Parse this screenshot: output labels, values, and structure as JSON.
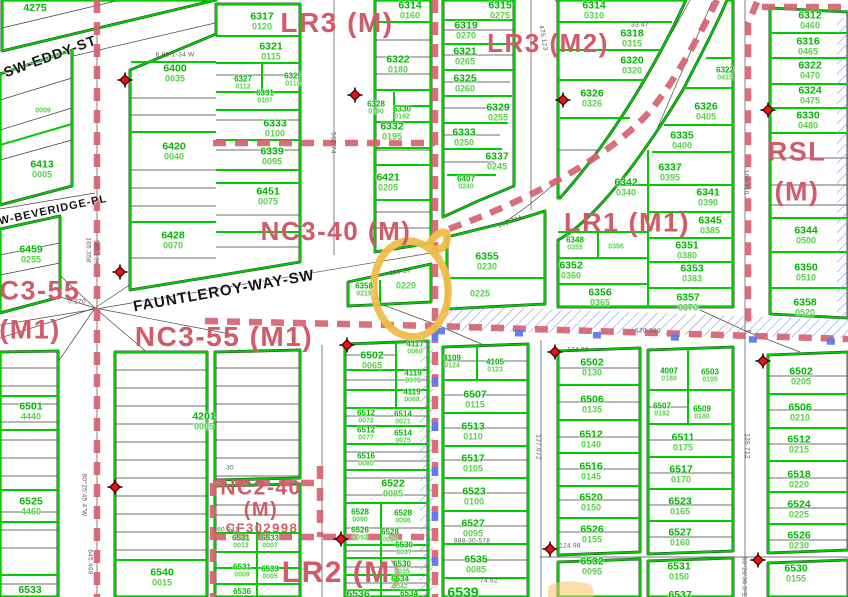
{
  "map": {
    "width": 848,
    "height": 597,
    "description": "zoning and parcel map with highlighted lot"
  },
  "colors": {
    "parcel_line": "#00cc00",
    "parcel_number_text": "#00b800",
    "lot_number_text": "#58d04a",
    "zoning_text": "#d15b68",
    "zoning_boundary": "#d5ününün"
  },
  "colors_fix": "see colors2",
  "colors2": {
    "parcel_line": "#00cc00",
    "parcel_number_text": "#00b800",
    "lot_number_text": "#58d04a",
    "zoning_text": "#d15b68",
    "zoning_boundary": "#d56370",
    "overlay_dash_blue": "#5b7bf0",
    "hatch_blue": "#7b8cf0",
    "marker_red": "#e81414",
    "highlight_orange": "#f0bd4a"
  },
  "highlight_circle": {
    "cx": 411,
    "cy": 289,
    "rx": 37,
    "ry": 48,
    "target_lot": "0220"
  },
  "zoning_labels": [
    {
      "text": "LR3 (M)",
      "x": 337,
      "y": 23,
      "size": 28
    },
    {
      "text": "LR3 (M2)",
      "x": 548,
      "y": 43,
      "size": 26
    },
    {
      "text": "LR1 (M1)",
      "x": 627,
      "y": 223,
      "size": 27
    },
    {
      "text": "RSL",
      "x": 797,
      "y": 152,
      "size": 27
    },
    {
      "text": "(M)",
      "x": 797,
      "y": 192,
      "size": 27
    },
    {
      "text": "NC3-40 (M)",
      "x": 336,
      "y": 231,
      "size": 26
    },
    {
      "text": "C3-55",
      "x": 40,
      "y": 291,
      "size": 27
    },
    {
      "text": "(M1)",
      "x": 30,
      "y": 330,
      "size": 27
    },
    {
      "text": "NC3-55 (M1)",
      "x": 224,
      "y": 337,
      "size": 28
    },
    {
      "text": "NC2-40",
      "x": 261,
      "y": 488,
      "size": 21
    },
    {
      "text": "(M)",
      "x": 261,
      "y": 510,
      "size": 20
    },
    {
      "text": "CF302998",
      "x": 262,
      "y": 528,
      "size": 13
    },
    {
      "text": "LR2 (M)",
      "x": 342,
      "y": 573,
      "size": 30
    }
  ],
  "street_labels": [
    {
      "text": "SW-EDDY-ST",
      "x": 50,
      "y": 56,
      "rot": -20,
      "size": 14
    },
    {
      "text": "SW-BEVERIDGE-PL",
      "x": 49,
      "y": 211,
      "rot": -12,
      "size": 11
    },
    {
      "text": "FAUNTLEROY-WAY-SW",
      "x": 224,
      "y": 291,
      "rot": -10,
      "size": 15
    }
  ],
  "parcel_labels": [
    {
      "n": "4275",
      "x": 35,
      "y": 8
    },
    {
      "l": "0009",
      "x": 43,
      "y": 111,
      "sz": "sm"
    },
    {
      "n": "6413",
      "l": "0005",
      "x": 42,
      "y": 169
    },
    {
      "n": "6459",
      "l": "0255",
      "x": 31,
      "y": 254
    },
    {
      "n": "6400",
      "l": "0035",
      "x": 175,
      "y": 73
    },
    {
      "n": "6420",
      "l": "0040",
      "x": 174,
      "y": 151
    },
    {
      "n": "6428",
      "l": "0070",
      "x": 173,
      "y": 240
    },
    {
      "n": "6317",
      "l": "0120",
      "x": 262,
      "y": 21
    },
    {
      "n": "6321",
      "l": "0115",
      "x": 271,
      "y": 51
    },
    {
      "n": "6325",
      "l": "0110",
      "x": 293,
      "y": 80,
      "sz": "sm"
    },
    {
      "n": "6327",
      "l": "0112",
      "x": 243,
      "y": 83,
      "sz": "sm"
    },
    {
      "n": "6331",
      "l": "0107",
      "x": 265,
      "y": 97,
      "sz": "sm"
    },
    {
      "n": "6333",
      "l": "0100",
      "x": 275,
      "y": 128
    },
    {
      "n": "6339",
      "l": "0095",
      "x": 272,
      "y": 156
    },
    {
      "n": "6451",
      "l": "0075",
      "x": 268,
      "y": 196
    },
    {
      "n": "6314",
      "l": "0160",
      "x": 410,
      "y": 10
    },
    {
      "n": "6322",
      "l": "0180",
      "x": 398,
      "y": 64
    },
    {
      "n": "6328",
      "l": "0190",
      "x": 376,
      "y": 108,
      "sz": "sm"
    },
    {
      "n": "6330",
      "l": "0192",
      "x": 402,
      "y": 113,
      "sz": "sm"
    },
    {
      "n": "6332",
      "l": "0195",
      "x": 392,
      "y": 131
    },
    {
      "n": "6421",
      "l": "0205",
      "x": 388,
      "y": 182
    },
    {
      "n": "6407",
      "l": "0240",
      "x": 466,
      "y": 183,
      "sz": "sm"
    },
    {
      "n": "6358",
      "l": "0219",
      "x": 364,
      "y": 290,
      "sz": "sm"
    },
    {
      "l": "0220",
      "x": 406,
      "y": 286
    },
    {
      "l": "0225",
      "x": 480,
      "y": 294
    },
    {
      "n": "6355",
      "l": "0230",
      "x": 487,
      "y": 261
    },
    {
      "n": "6315",
      "l": "0275",
      "x": 500,
      "y": 10
    },
    {
      "n": "6319",
      "l": "0270",
      "x": 466,
      "y": 30
    },
    {
      "n": "6321",
      "l": "0265",
      "x": 465,
      "y": 56
    },
    {
      "n": "6325",
      "l": "0260",
      "x": 465,
      "y": 83
    },
    {
      "n": "6329",
      "l": "0255",
      "x": 498,
      "y": 112
    },
    {
      "n": "6333",
      "l": "0250",
      "x": 464,
      "y": 137
    },
    {
      "n": "6337",
      "l": "0245",
      "x": 497,
      "y": 161
    },
    {
      "n": "6314",
      "l": "0310",
      "x": 594,
      "y": 10
    },
    {
      "n": "6318",
      "l": "0315",
      "x": 632,
      "y": 38
    },
    {
      "n": "6320",
      "l": "0320",
      "x": 632,
      "y": 65
    },
    {
      "n": "6326",
      "l": "0326",
      "x": 592,
      "y": 98
    },
    {
      "n": "6342",
      "l": "0340",
      "x": 626,
      "y": 187
    },
    {
      "n": "6337",
      "l": "0395",
      "x": 670,
      "y": 172
    },
    {
      "n": "6341",
      "l": "0390",
      "x": 708,
      "y": 197
    },
    {
      "n": "6345",
      "l": "0385",
      "x": 710,
      "y": 225
    },
    {
      "n": "6348",
      "l": "0355",
      "x": 575,
      "y": 244,
      "sz": "sm"
    },
    {
      "l": "0356",
      "x": 616,
      "y": 247,
      "sz": "sm"
    },
    {
      "n": "6352",
      "l": "0360",
      "x": 571,
      "y": 270
    },
    {
      "n": "6351",
      "l": "0380",
      "x": 687,
      "y": 250
    },
    {
      "n": "6353",
      "l": "0383",
      "x": 692,
      "y": 273
    },
    {
      "n": "6356",
      "l": "0365",
      "x": 600,
      "y": 297
    },
    {
      "n": "6357",
      "l": "0370",
      "x": 688,
      "y": 302
    },
    {
      "n": "6322",
      "l": "0415",
      "x": 725,
      "y": 74,
      "sz": "sm"
    },
    {
      "n": "6326",
      "l": "0405",
      "x": 706,
      "y": 111
    },
    {
      "n": "6335",
      "l": "0400",
      "x": 682,
      "y": 140
    },
    {
      "n": "6312",
      "l": "0460",
      "x": 810,
      "y": 20
    },
    {
      "n": "6316",
      "l": "0465",
      "x": 808,
      "y": 46
    },
    {
      "n": "6322",
      "l": "0470",
      "x": 810,
      "y": 70
    },
    {
      "n": "6324",
      "l": "0475",
      "x": 810,
      "y": 95
    },
    {
      "n": "6330",
      "l": "0480",
      "x": 808,
      "y": 120
    },
    {
      "n": "6344",
      "l": "0500",
      "x": 806,
      "y": 235
    },
    {
      "n": "6350",
      "l": "0510",
      "x": 806,
      "y": 272
    },
    {
      "n": "6358",
      "l": "0520",
      "x": 805,
      "y": 307
    },
    {
      "n": "6501",
      "l": "4440",
      "x": 31,
      "y": 411
    },
    {
      "n": "6525",
      "l": "4460",
      "x": 31,
      "y": 506
    },
    {
      "n": "6533",
      "x": 30,
      "y": 590
    },
    {
      "n": "4201",
      "l": "0005",
      "x": 204,
      "y": 421
    },
    {
      "n": "6540",
      "l": "0015",
      "x": 162,
      "y": 577
    },
    {
      "n": "6531",
      "l": "0013",
      "x": 241,
      "y": 542,
      "sz": "sm"
    },
    {
      "n": "6533",
      "l": "0007",
      "x": 270,
      "y": 542,
      "sz": "sm"
    },
    {
      "n": "6531",
      "l": "0009",
      "x": 242,
      "y": 571,
      "sz": "sm"
    },
    {
      "n": "6533",
      "l": "0005",
      "x": 270,
      "y": 573,
      "sz": "sm"
    },
    {
      "n": "6536",
      "x": 242,
      "y": 592,
      "sz": "sm"
    },
    {
      "n": "6502",
      "l": "0065",
      "x": 372,
      "y": 360
    },
    {
      "n": "4117",
      "l": "0060",
      "x": 415,
      "y": 348,
      "sz": "sm"
    },
    {
      "n": "4119",
      "l": "0070",
      "x": 413,
      "y": 377,
      "sz": "sm"
    },
    {
      "n": "4119",
      "l": "0068",
      "x": 412,
      "y": 396,
      "sz": "sm"
    },
    {
      "n": "6512",
      "l": "0072",
      "x": 366,
      "y": 417,
      "sz": "sm"
    },
    {
      "n": "6514",
      "l": "0071",
      "x": 403,
      "y": 418,
      "sz": "sm"
    },
    {
      "n": "6512",
      "l": "0077",
      "x": 366,
      "y": 434,
      "sz": "sm"
    },
    {
      "n": "6514",
      "l": "0075",
      "x": 403,
      "y": 437,
      "sz": "sm"
    },
    {
      "n": "6516",
      "l": "0080",
      "x": 366,
      "y": 460,
      "sz": "sm"
    },
    {
      "n": "6522",
      "l": "0085",
      "x": 393,
      "y": 488
    },
    {
      "n": "6528",
      "l": "0090",
      "x": 360,
      "y": 516,
      "sz": "sm"
    },
    {
      "n": "6528",
      "l": "0096",
      "x": 403,
      "y": 517,
      "sz": "sm"
    },
    {
      "n": "6526",
      "l": "0092",
      "x": 360,
      "y": 534,
      "sz": "sm"
    },
    {
      "n": "6528",
      "l": "0094",
      "x": 390,
      "y": 536,
      "sz": "sm"
    },
    {
      "n": "6530",
      "l": "0037",
      "x": 404,
      "y": 549,
      "sz": "sm"
    },
    {
      "n": "6530",
      "l": "0035",
      "x": 402,
      "y": 568,
      "sz": "sm"
    },
    {
      "n": "6534",
      "l": "0042",
      "x": 400,
      "y": 583,
      "sz": "sm"
    },
    {
      "n": "6536",
      "x": 358,
      "y": 594
    },
    {
      "n": "6534",
      "x": 409,
      "y": 594,
      "sz": "sm"
    },
    {
      "n": "4109",
      "l": "0124",
      "x": 452,
      "y": 362,
      "sz": "sm"
    },
    {
      "n": "4105",
      "l": "0123",
      "x": 495,
      "y": 366,
      "sz": "sm"
    },
    {
      "n": "6507",
      "l": "0115",
      "x": 475,
      "y": 399
    },
    {
      "n": "6513",
      "l": "0110",
      "x": 473,
      "y": 431
    },
    {
      "n": "6517",
      "l": "0105",
      "x": 473,
      "y": 463
    },
    {
      "n": "6523",
      "l": "0100",
      "x": 474,
      "y": 496
    },
    {
      "n": "6527",
      "l": "0095",
      "x": 473,
      "y": 528
    },
    {
      "n": "6535",
      "l": "0085",
      "x": 476,
      "y": 564
    },
    {
      "n": "6539",
      "x": 463,
      "y": 592,
      "sz": "lg"
    },
    {
      "n": "6502",
      "l": "0130",
      "x": 592,
      "y": 367
    },
    {
      "n": "6506",
      "l": "0135",
      "x": 592,
      "y": 404
    },
    {
      "n": "6512",
      "l": "0140",
      "x": 591,
      "y": 439
    },
    {
      "n": "6516",
      "l": "0145",
      "x": 591,
      "y": 471
    },
    {
      "n": "6520",
      "l": "0150",
      "x": 591,
      "y": 502
    },
    {
      "n": "6526",
      "l": "0155",
      "x": 592,
      "y": 534
    },
    {
      "n": "6532",
      "l": "0095",
      "x": 592,
      "y": 566
    },
    {
      "n": "4007",
      "l": "0189",
      "x": 669,
      "y": 375,
      "sz": "sm"
    },
    {
      "n": "6503",
      "l": "0195",
      "x": 710,
      "y": 376,
      "sz": "sm"
    },
    {
      "n": "6507",
      "l": "0182",
      "x": 662,
      "y": 410,
      "sz": "sm"
    },
    {
      "n": "6509",
      "l": "0180",
      "x": 702,
      "y": 413,
      "sz": "sm"
    },
    {
      "n": "6511",
      "l": "0175",
      "x": 683,
      "y": 442
    },
    {
      "n": "6517",
      "l": "0170",
      "x": 681,
      "y": 474
    },
    {
      "n": "6523",
      "l": "0165",
      "x": 680,
      "y": 506
    },
    {
      "n": "6527",
      "l": "0160",
      "x": 680,
      "y": 537
    },
    {
      "n": "6531",
      "l": "0150",
      "x": 679,
      "y": 571
    },
    {
      "n": "6537",
      "x": 680,
      "y": 595
    },
    {
      "n": "6502",
      "l": "0205",
      "x": 801,
      "y": 376
    },
    {
      "n": "6506",
      "l": "0210",
      "x": 800,
      "y": 412
    },
    {
      "n": "6512",
      "l": "0215",
      "x": 799,
      "y": 444
    },
    {
      "n": "6518",
      "l": "0220",
      "x": 799,
      "y": 479
    },
    {
      "n": "6524",
      "l": "0225",
      "x": 799,
      "y": 509
    },
    {
      "n": "6526",
      "l": "0230",
      "x": 799,
      "y": 540
    },
    {
      "n": "6530",
      "l": "0155",
      "x": 796,
      "y": 573
    }
  ],
  "dimension_labels": [
    {
      "t": "8 86-1-34 W",
      "x": 175,
      "y": 55,
      "r": 0
    },
    {
      "t": "562.74",
      "x": 333,
      "y": 143,
      "r": 90
    },
    {
      "t": "475.123",
      "x": 543,
      "y": 38,
      "r": 80
    },
    {
      "t": "162.704",
      "x": 510,
      "y": 222,
      "r": -20
    },
    {
      "t": "160.110",
      "x": 746,
      "y": 182,
      "r": 90
    },
    {
      "t": "165.358",
      "x": 88,
      "y": 250,
      "r": 90
    },
    {
      "t": "185.139",
      "x": 96,
      "y": 252,
      "r": 90
    },
    {
      "t": "80°25'45.4\"W",
      "x": 84,
      "y": 495,
      "r": 90
    },
    {
      "t": "645.469",
      "x": 90,
      "y": 562,
      "r": 90
    },
    {
      "t": "360.941",
      "x": 226,
      "y": 530,
      "r": 0
    },
    {
      "t": "888-30-578",
      "x": 472,
      "y": 541,
      "r": 0
    },
    {
      "t": "139.712",
      "x": 747,
      "y": 446,
      "r": 90
    },
    {
      "t": "137.672",
      "x": 538,
      "y": 447,
      "r": 90
    },
    {
      "t": "80°26'36.5\"E",
      "x": 744,
      "y": 577,
      "r": 90
    },
    {
      "t": "124.98",
      "x": 578,
      "y": 350,
      "r": 0
    },
    {
      "t": "124.98",
      "x": 570,
      "y": 546,
      "r": 0
    },
    {
      "t": "33.47",
      "x": 640,
      "y": 25,
      "r": 0
    },
    {
      "t": "116.39",
      "x": 400,
      "y": 272,
      "r": -8
    },
    {
      "t": "74.62",
      "x": 489,
      "y": 581,
      "r": 0
    },
    {
      "t": "120  360",
      "x": 648,
      "y": 331,
      "r": 2
    },
    {
      "t": "0.270",
      "x": 77,
      "y": 302,
      "r": 0
    },
    {
      "t": "30",
      "x": 230,
      "y": 468,
      "r": 0
    }
  ],
  "markers": {
    "type": "survey-cross",
    "points": [
      [
        125,
        80
      ],
      [
        355,
        95
      ],
      [
        563,
        100
      ],
      [
        768,
        110
      ],
      [
        120,
        272
      ],
      [
        347,
        345
      ],
      [
        555,
        352
      ],
      [
        763,
        361
      ],
      [
        115,
        487
      ],
      [
        341,
        539
      ],
      [
        550,
        549
      ],
      [
        758,
        560
      ]
    ]
  }
}
